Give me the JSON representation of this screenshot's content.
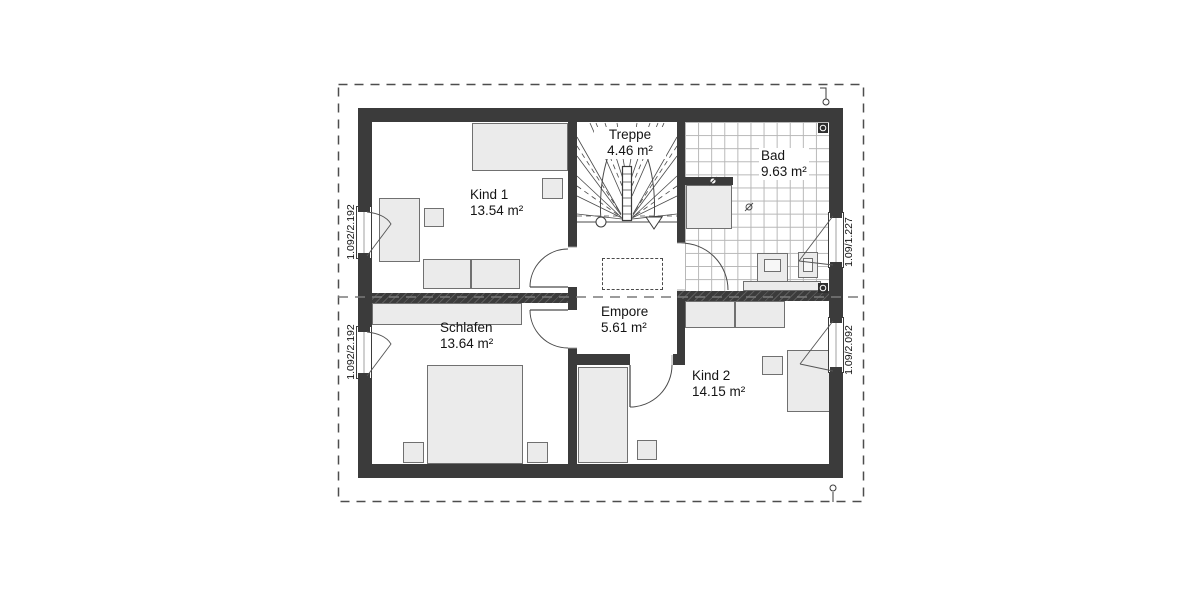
{
  "rooms": {
    "kind1": {
      "name": "Kind 1",
      "area": "13.54 m²"
    },
    "treppe": {
      "name": "Treppe",
      "area": "4.46 m²"
    },
    "bad": {
      "name": "Bad",
      "area": "9.63 m²"
    },
    "empore": {
      "name": "Empore",
      "area": "5.61 m²"
    },
    "schlafen": {
      "name": "Schlafen",
      "area": "13.64 m²"
    },
    "kind2": {
      "name": "Kind 2",
      "area": "14.15 m²"
    }
  },
  "window_dimensions": {
    "left_top": "1.092/2.192",
    "left_bottom": "1.092/2.192",
    "right_top": "1.09/1.227",
    "right_bottom": "1.09/2.092"
  },
  "colors": {
    "wall": "#3b3b3b",
    "furniture_fill": "#ebebeb",
    "tile_line": "#b7b7b7",
    "boundary_dash": "#4d4d4d"
  }
}
